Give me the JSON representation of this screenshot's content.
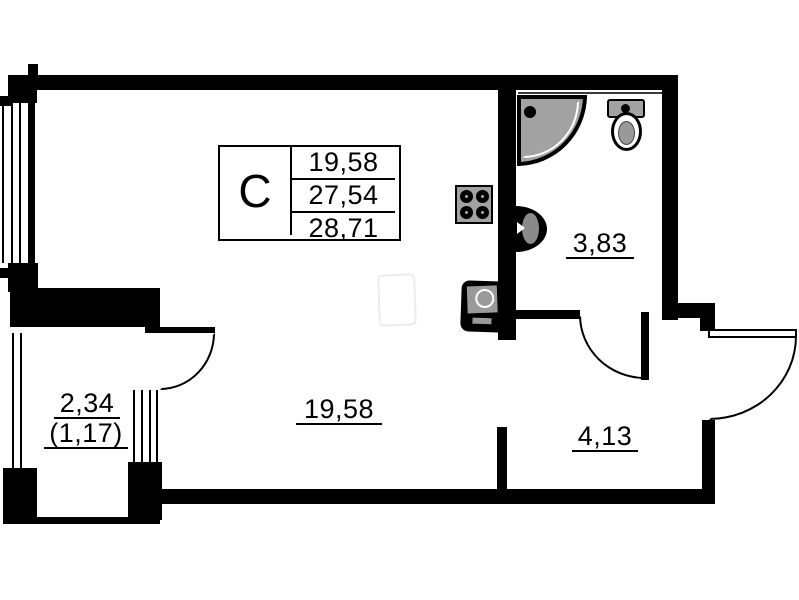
{
  "plan": {
    "title_box": {
      "unit_type": "С",
      "values": [
        "19,58",
        "27,54",
        "28,71"
      ]
    },
    "rooms": {
      "living": {
        "area": "19,58"
      },
      "bathroom": {
        "area": "3,83"
      },
      "hall": {
        "area": "4,13"
      },
      "balcony": {
        "area_full": "2,34",
        "area_reduced": "(1,17)"
      }
    },
    "colors": {
      "wall": "#000000",
      "fixture_fill": "#a2a2a2",
      "ghost_outline": "#ececec",
      "background": "#ffffff"
    }
  }
}
